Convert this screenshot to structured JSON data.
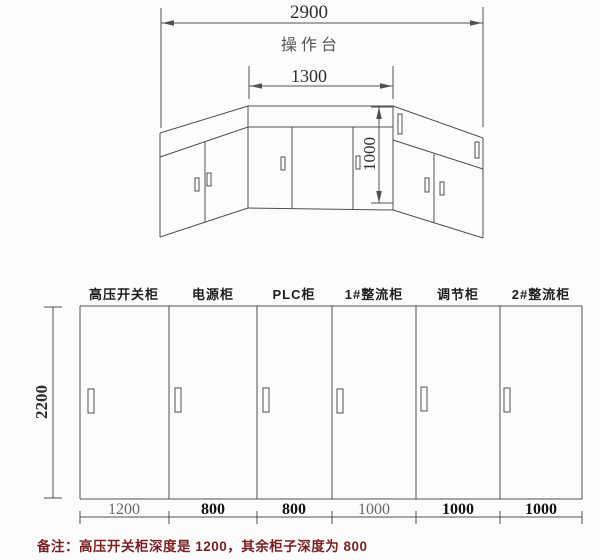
{
  "top_view": {
    "title": "操作台",
    "dims": {
      "total_width": "2900",
      "center_width": "1300",
      "depth": "1000"
    }
  },
  "front_view": {
    "height_dim": "2200",
    "cabinets": [
      {
        "name": "高压开关柜",
        "width": "1200"
      },
      {
        "name": "电源柜",
        "width": "800"
      },
      {
        "name": "PLC柜",
        "width": "800"
      },
      {
        "name": "1#整流柜",
        "width": "1000"
      },
      {
        "name": "调节柜",
        "width": "1000"
      },
      {
        "name": "2#整流柜",
        "width": "1000"
      }
    ]
  },
  "note": {
    "text": "备注：高压开关柜深度是 1200，其余柜子深度为 800"
  },
  "colors": {
    "line": "#4f4f4f",
    "dim_text": "#2e2e2e",
    "note_text": "#7a1f1f"
  }
}
